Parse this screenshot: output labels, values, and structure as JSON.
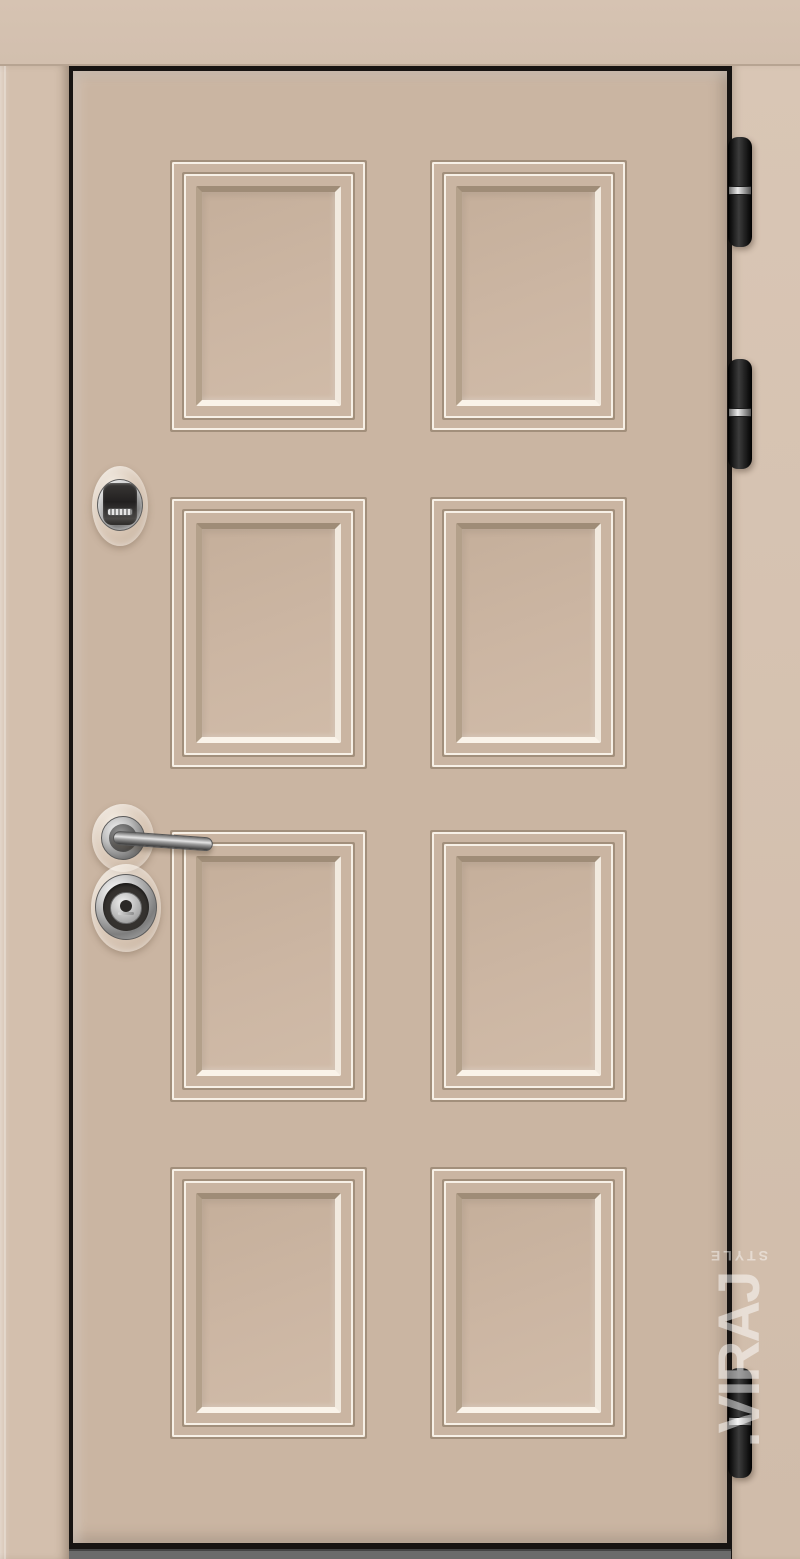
{
  "scene": {
    "subject": "beige entrance door product photo",
    "panel_grid": {
      "rows": 4,
      "cols": 2
    },
    "hinge_count": 3
  },
  "watermark": {
    "text": ".VIRAJ",
    "sub": "STYLE"
  },
  "hardware": {
    "upper": "cylinder-escutcheon",
    "middle": "lever-handle",
    "lower": "armored-lock-cover"
  },
  "colors": {
    "wall": "#d6c3b2",
    "casing": "#d3bfad",
    "jamb": "#d0bcaa",
    "door": "#cab5a2",
    "panelField": "#ccb6a3",
    "moldingHighlight": "#f7f0e6",
    "moldingShadow": "#a28f7b",
    "frameGap": "#171412",
    "threshold": "#6b6b6b",
    "hinge": "#1a1a1a",
    "chrome": "#c9c9c9"
  },
  "layout": {
    "panels": {
      "col_x": [
        97,
        357
      ],
      "row_y": [
        89,
        426,
        759,
        1096
      ],
      "width": 197,
      "height": 272
    },
    "hinges": {
      "x": 728,
      "width": 24,
      "height": 110,
      "positions_y": [
        137,
        359,
        1368
      ]
    }
  }
}
